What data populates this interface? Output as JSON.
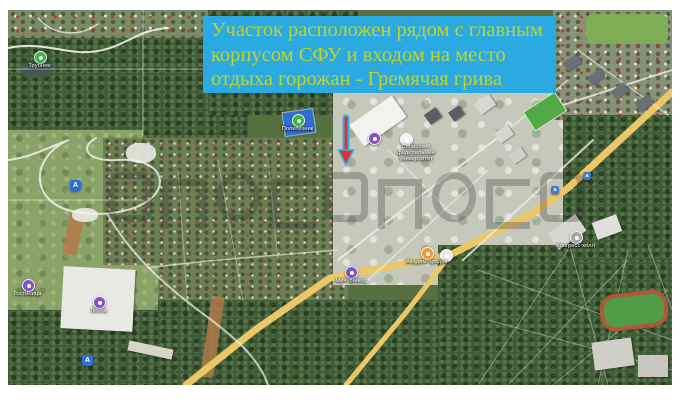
{
  "annotation_banner": {
    "bg_color": "#2baae2",
    "text_color": "#c0d42e",
    "lines": [
      "Участок расположен рядом с главным",
      "корпусом СФУ и входом на место",
      "отдыха горожан - Гремячая грива"
    ]
  },
  "map": {
    "type": "satellite",
    "arrow_annotation": {
      "direction": "down",
      "color": "#e2312a",
      "outline_color": "#2ab3e8"
    },
    "markers": [
      {
        "id": "trubnoye",
        "type": "circle",
        "color": "#3cb44a",
        "x": 26,
        "y": 41,
        "label": "Трубное"
      },
      {
        "id": "road-sign-a",
        "type": "square",
        "color": "#2f6fd4",
        "glyph": "А",
        "x": 62,
        "y": 170
      },
      {
        "id": "stadium",
        "type": "circle",
        "color": "#3cb44a",
        "x": 284,
        "y": 104,
        "label": "Политехник"
      },
      {
        "id": "sfu-pin",
        "type": "circle",
        "color": "#8053c5",
        "x": 360,
        "y": 122
      },
      {
        "id": "campus-dot",
        "type": "circle",
        "color": "#f2f2f2",
        "x": 392,
        "y": 123
      },
      {
        "id": "sfu-label",
        "type": "label",
        "x": 408,
        "y": 134,
        "label": "Сибирский федеральный университет"
      },
      {
        "id": "michurinets",
        "type": "circle",
        "color": "#8053c5",
        "x": 337,
        "y": 256,
        "label": "Мичуринец"
      },
      {
        "id": "akademgorodok",
        "type": "circle",
        "color": "#f0992e",
        "x": 413,
        "y": 237,
        "label": "Академгородок"
      },
      {
        "id": "junction-dot",
        "type": "circle",
        "color": "#e9e9e9",
        "x": 432,
        "y": 239
      },
      {
        "id": "hotel",
        "type": "circle",
        "color": "#8053c5",
        "x": 14,
        "y": 269,
        "label": "Гостиница"
      },
      {
        "id": "lenta",
        "type": "circle",
        "color": "#8053c5",
        "x": 85,
        "y": 286,
        "label": "Лента"
      },
      {
        "id": "kongress-holl",
        "type": "circle",
        "color": "#a7a7a7",
        "x": 562,
        "y": 221,
        "label": "Конгресс-холл"
      },
      {
        "id": "road-sign-b",
        "type": "square",
        "color": "#2f6fd4",
        "glyph": "А",
        "x": 74,
        "y": 345
      },
      {
        "id": "bus-stop-1",
        "type": "square",
        "color": "#3a7bd5",
        "glyph": "а",
        "x": 575,
        "y": 162,
        "small": true
      },
      {
        "id": "bus-stop-2",
        "type": "square",
        "color": "#3a7bd5",
        "glyph": "а",
        "x": 543,
        "y": 176,
        "small": true
      }
    ]
  },
  "watermark": {
    "glyph_count": 9,
    "opacity": 0.5,
    "legibility": "illegible embossed letters"
  }
}
